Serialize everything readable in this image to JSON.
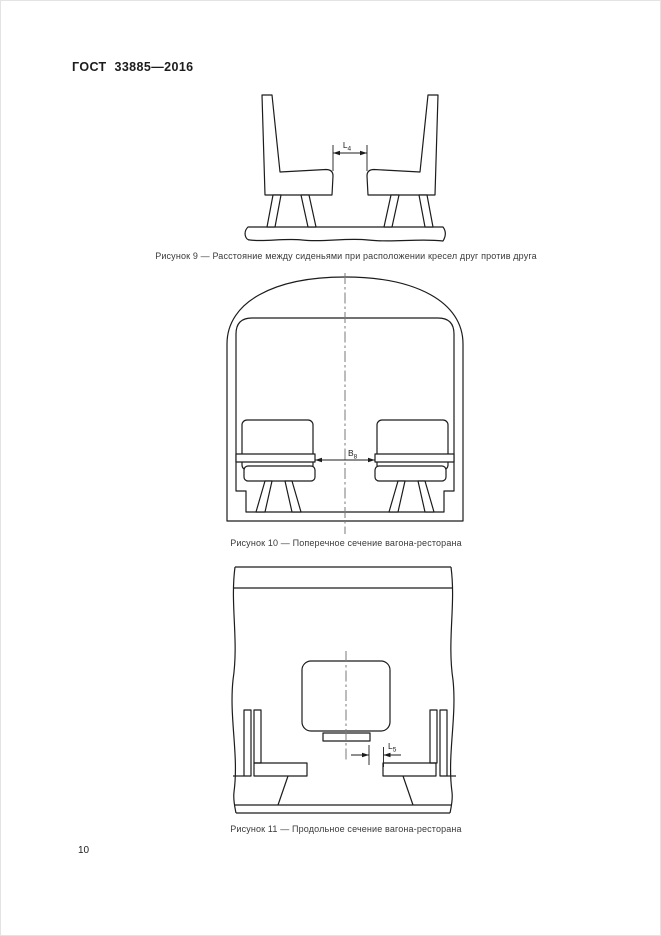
{
  "document": {
    "header": "ГОСТ 33885—2016",
    "page_number": "10"
  },
  "figures": {
    "fig9": {
      "caption": "Рисунок 9 — Расстояние между сиденьями при расположении кресел друг против друга",
      "dim_main": "L",
      "dim_sub": "4"
    },
    "fig10": {
      "caption": "Рисунок 10 — Поперечное сечение вагона-ресторана",
      "dim_main": "B",
      "dim_sub": "8"
    },
    "fig11": {
      "caption": "Рисунок 11 — Продольное сечение вагона-ресторана",
      "dim_main": "L",
      "dim_sub": "5"
    }
  },
  "colors": {
    "line": "#1c1c1c",
    "centerline": "#7a7a7a",
    "text": "#1c1c1c",
    "caption": "#3a3a3a",
    "background": "#ffffff"
  }
}
